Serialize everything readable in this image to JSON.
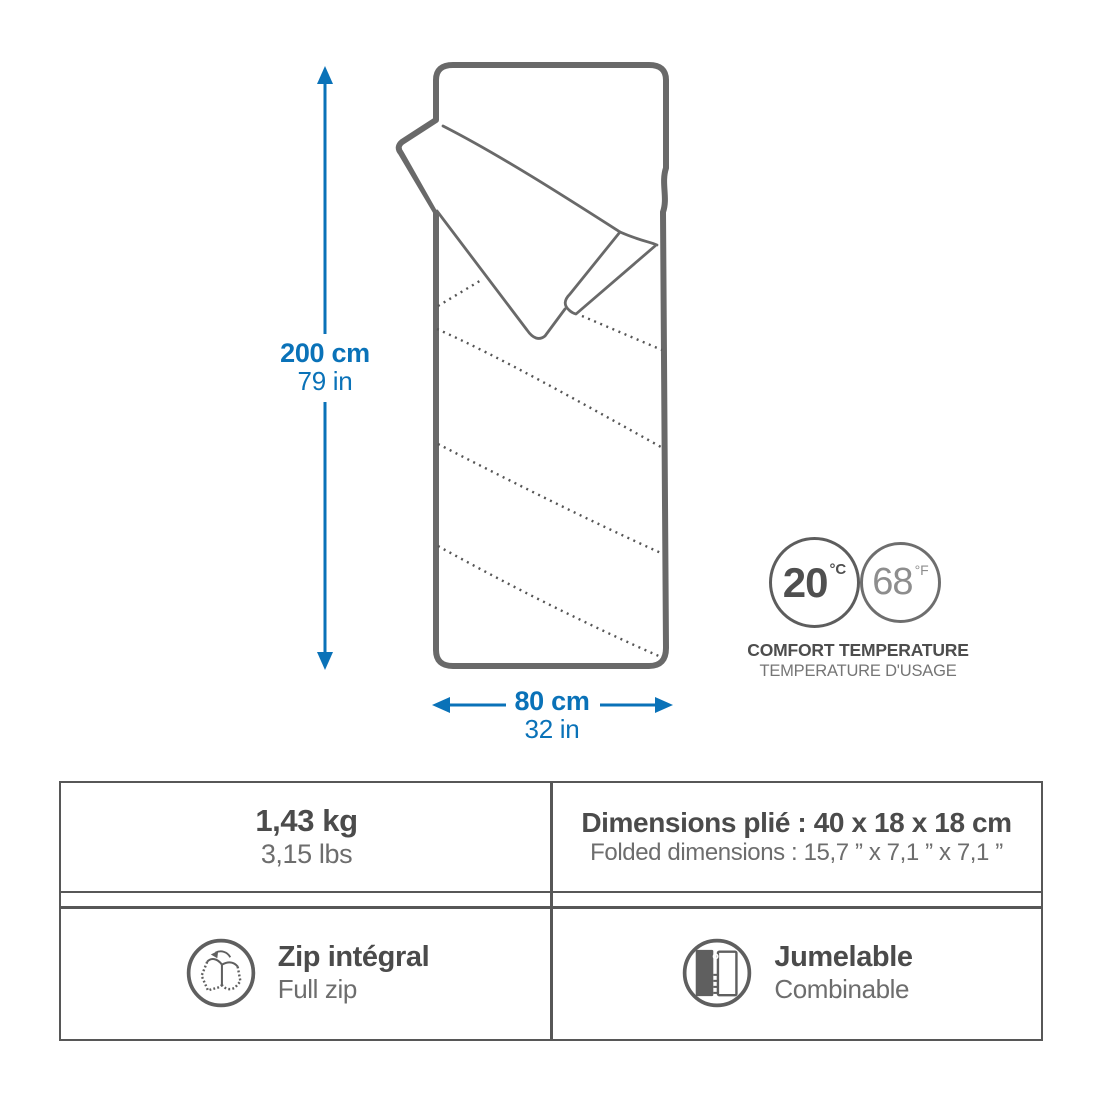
{
  "product_diagram": {
    "subject": "sleeping-bag-open-corner-illustration",
    "dimensions": {
      "height": {
        "metric": "200 cm",
        "imperial": "79 in"
      },
      "width": {
        "metric": "80 cm",
        "imperial": "32 in"
      }
    },
    "temperature": {
      "celsius_value": "20",
      "celsius_unit": "°C",
      "fahrenheit_value": "68",
      "fahrenheit_unit": "°F",
      "label_en": "COMFORT TEMPERATURE",
      "label_fr": "TEMPERATURE D'USAGE"
    }
  },
  "spec_table": {
    "weight": {
      "primary": "1,43 kg",
      "secondary": "3,15 lbs"
    },
    "folded": {
      "primary": "Dimensions plié : 40 x 18 x 18 cm",
      "secondary": "Folded dimensions : 15,7 ” x 7,1 ” x 7,1 ”"
    },
    "zip": {
      "primary": "Zip intégral",
      "secondary": "Full zip"
    },
    "pairing": {
      "primary": "Jumelable",
      "secondary": "Combinable"
    }
  },
  "icons": {
    "zip": "full-zip-open-bag-icon",
    "pairing": "zip-together-icon",
    "arrows": "blue-dimension-arrows"
  },
  "colors": {
    "accent_blue": "#0a72b8",
    "line_gray": "#696969",
    "text_dark": "#4b4b4b",
    "text_mid": "#6d6d6d",
    "border_gray": "#575757"
  }
}
